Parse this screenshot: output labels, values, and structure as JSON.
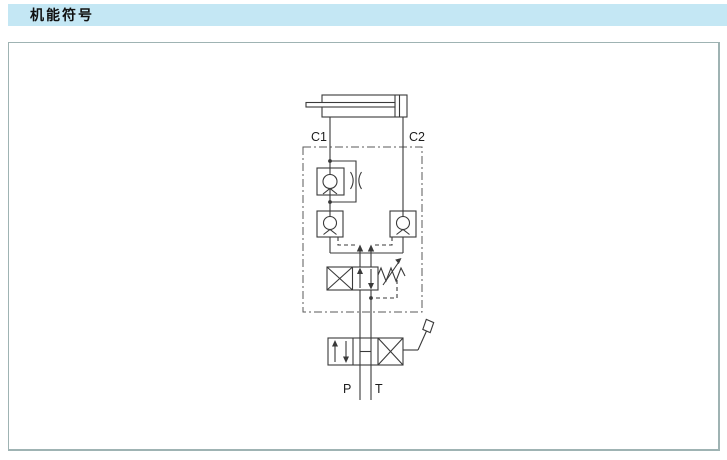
{
  "header": {
    "title": "机能符号"
  },
  "colors": {
    "header_bg": "#c4e7f4",
    "frame_border": "#9fb3b3",
    "line": "#3a3a3a"
  },
  "diagram": {
    "labels": {
      "c1": "C1",
      "c2": "C2",
      "p": "P",
      "t": "T"
    },
    "components": [
      "hydraulic-cylinder",
      "one-way-throttle-valve",
      "pilot-operated-check-valve-left",
      "pilot-operated-check-valve-right",
      "pilot-counterbalance-valve",
      "manual-lever-directional-valve"
    ]
  }
}
